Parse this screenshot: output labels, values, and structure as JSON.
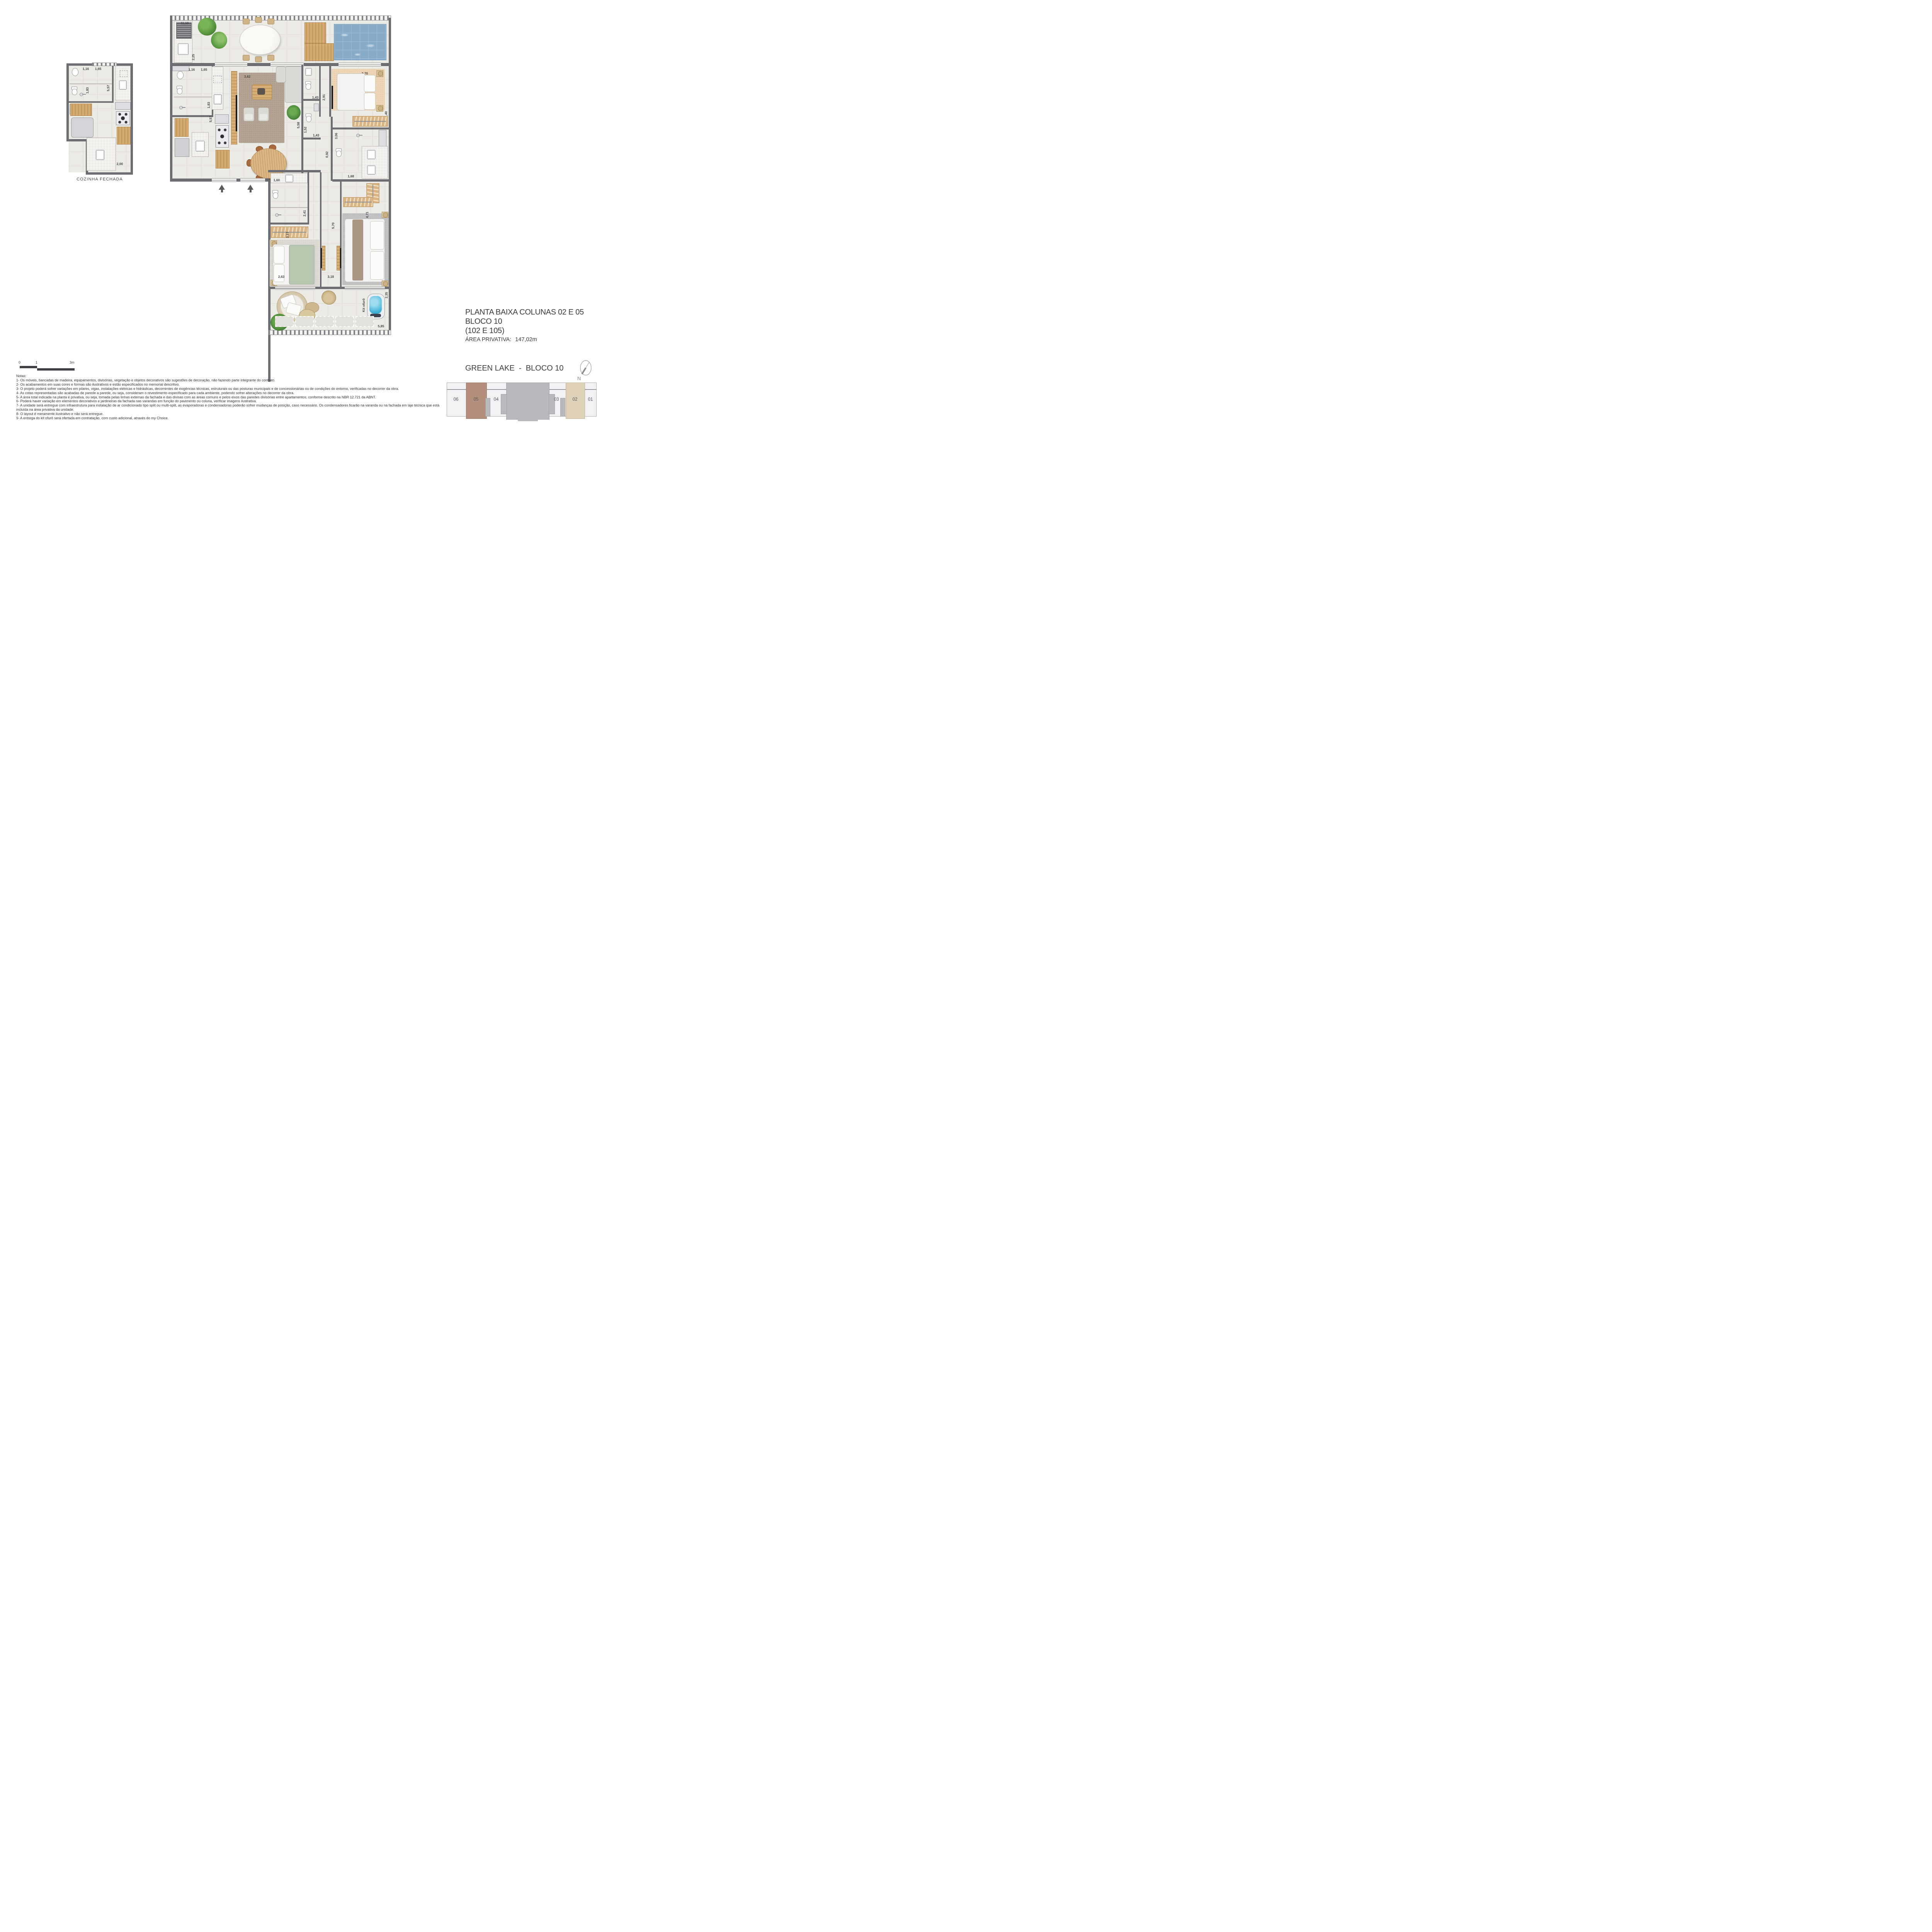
{
  "colors": {
    "wall": "#6c6e73",
    "floor_tile": "#edebe6",
    "wood": "#cda26b",
    "pool_water": "#86abc8",
    "key_highlight_05": "#b48f7c",
    "key_highlight_02": "#ded2b9",
    "key_core_gray": "#b9b9bd",
    "key_light": "#f2f2f4"
  },
  "cozinha_plan": {
    "caption": "COZINHA FECHADA",
    "dims": {
      "c1_16": "1,16",
      "c1_65": "1,65",
      "c1_83": "1,83",
      "c5_57": "5,57",
      "c2_00": "2,00"
    }
  },
  "main_plan": {
    "kit_ofuro": "Kit ofurô",
    "dims": {
      "d11_10": "11,10",
      "d2_25": "2,25",
      "d1_16": "1,16",
      "d1_65": "1,65",
      "d1_83": "1,83",
      "d5_57": "5,57",
      "d3_62": "3,62",
      "d2_91": "2,91",
      "d2_70": "2,70",
      "d3_40": "3,40",
      "d1_43a": "1,43",
      "d5_58": "5,58",
      "d1_52": "1,52",
      "d1_43b": "1,43",
      "d0_92": "0,92",
      "d3_06": "3,06",
      "d1_68": "1,68",
      "d1_60": "1,60",
      "d2_41": "2,41",
      "d3_17": "3,17",
      "d5_70": "5,70",
      "d4_71": "4,71",
      "d2_63": "2,63",
      "d3_18": "3,18",
      "d2_35": "2,35",
      "d5_85": "5,85"
    }
  },
  "title_block": {
    "line1": "PLANTA BAIXA COLUNAS 02 E 05",
    "line2": "BLOCO 10",
    "line3": "(102 E 105)",
    "area_label": "ÁREA PRIVATIVA:",
    "area_value": "147,02m"
  },
  "project": {
    "name": "GREEN LAKE  -  BLOCO 10",
    "north": "N"
  },
  "key_plan": {
    "units": [
      "06",
      "05",
      "04",
      "03",
      "02",
      "01"
    ]
  },
  "scale_bar": {
    "t0": "0",
    "t1": "1",
    "t3": "3m"
  },
  "notes": {
    "title": "Notas:",
    "items": [
      "1- Os móveis, bancadas de madeira, equipamentos, divisórias, vegetação e objetos decorativos são sugestões de decoração, não fazendo parte integrante do contrato.",
      "2- Os acabamentos em suas cores e formas são ilustrativos e estão especificados no memorial descritivo.",
      "3- O projeto poderá sofrer variações em pilares, vigas, instalações elétricas e hidráulicas, decorrentes de exigências técnicas, estruturais ou das posturas municipais e de concessionárias ou de condições do entorno, verificadas no decorrer da obra.",
      "4- As cotas representadas são acabadas de parede a parede, ou seja, consideram o revestimento especificado para cada ambiente, podendo sofrer alterações no decorrer da obra.",
      "5- A área total indicada na planta é privativa, ou seja, tomada pelas linhas externas da fachada e das divisas com as áreas comuns e pelos eixos das paredes divisórias entre apartamentos, conforme descrito na NBR 12.721 da ABNT.",
      "6- Poderá haver variação em elementos decorativos e jardineiras da fachada nas varandas em função do pavimento ou coluna, verificar imagens ilustrativa.",
      "7- A unidade será entregue com infraestrutura para instalação de ar condicionado tipo split ou multi-split, as evaporadoras e condensadoras poderão sofrer mudanças de posição, caso necessário. Os condensadores ficarão na varanda ou na fachada em laje técnica que está incluída na área privativa da unidade.",
      "8- O layout é meramente ilustrativo e não será entregue.",
      "9- A entrega do kit ofurô será ofertada em contratação, com custo adicional, através do my Choice."
    ]
  }
}
